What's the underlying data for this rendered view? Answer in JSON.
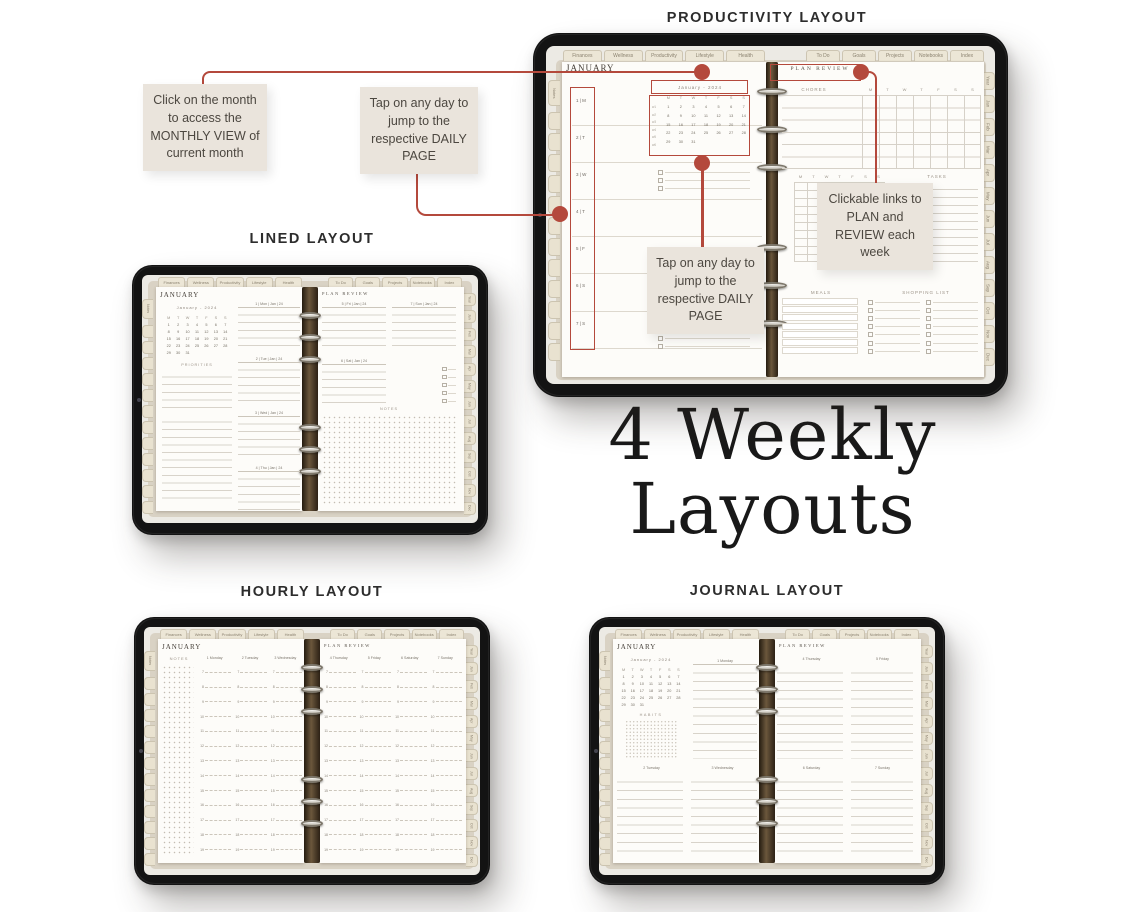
{
  "titles": {
    "productivity": "PRODUCTIVITY LAYOUT",
    "lined": "LINED LAYOUT",
    "hourly": "HOURLY LAYOUT",
    "journal": "JOURNAL LAYOUT"
  },
  "headline": {
    "line1": "4 Weekly",
    "line2": "Layouts"
  },
  "callouts": {
    "monthly_view": "Click on the month to access the MONTHLY VIEW of current month",
    "daily_page_top": "Tap on any day to jump to the respective DAILY PAGE",
    "plan_review_links": "Clickable links to PLAN and REVIEW each week",
    "daily_page_mid": "Tap on any day to jump to the respective DAILY PAGE"
  },
  "colors": {
    "accent_red": "#b4493c",
    "callout_bg": "#eae4dc",
    "callout_text": "#4c4740",
    "tablet_frame": "#131313",
    "planner_cover": "#d9d2c4",
    "tab_beige": "#e9e2d0",
    "page_white": "#fdfcf9",
    "spine_brown": "#6b573c"
  },
  "planner": {
    "tabs_top_left": [
      "Finances",
      "Wellness",
      "Productivity",
      "Lifestyle",
      "Health"
    ],
    "tabs_top_right": [
      "To Do",
      "Goals",
      "Projects",
      "Notebooks",
      "Index"
    ],
    "tabs_right": [
      "Year",
      "Jan",
      "Feb",
      "Mar",
      "Apr",
      "May",
      "Jun",
      "Jul",
      "Aug",
      "Sep",
      "Oct",
      "Nov",
      "Dec"
    ],
    "notes_tab": "Notes",
    "tabs_left_blanks": [
      "",
      "",
      "",
      "",
      "",
      "",
      "",
      "",
      "",
      "",
      "",
      ""
    ],
    "month_title": "JANUARY",
    "plan_review_title": "PLAN REVIEW",
    "mini_calendar": {
      "header": "January - 2024",
      "weekdays": [
        "M",
        "T",
        "W",
        "T",
        "F",
        "S",
        "S"
      ],
      "week_labels": [
        "w1",
        "w2",
        "w3",
        "w4",
        "w5",
        "w6"
      ],
      "days": [
        "1",
        "2",
        "3",
        "4",
        "5",
        "6",
        "7",
        "8",
        "9",
        "10",
        "11",
        "12",
        "13",
        "14",
        "15",
        "16",
        "17",
        "18",
        "19",
        "20",
        "21",
        "22",
        "23",
        "24",
        "25",
        "26",
        "27",
        "28",
        "29",
        "30",
        "31"
      ]
    }
  },
  "productivity": {
    "day_rows": [
      "1 | M",
      "2 | T",
      "3 | W",
      "4 | T",
      "5 | F",
      "6 | S",
      "7 | S"
    ],
    "chores_label": "CHORES",
    "weekday_cols": [
      "M",
      "T",
      "W",
      "T",
      "F",
      "S",
      "S"
    ],
    "tasks_label": "TASKS",
    "meals_label": "MEALS",
    "shopping_label": "SHOPPING LIST"
  },
  "lined": {
    "priorities_label": "PRIORITIES",
    "notes_label": "NOTES",
    "day_headers_left": [
      "1 | Mon | Jan | 24",
      "2 | Tue | Jan | 24",
      "3 | Wed | Jan | 24",
      "4 | Thu | Jan | 24"
    ],
    "day_headers_right_top": [
      "5 | Fri | Jan | 24",
      "7 | Sun | Jan | 24"
    ],
    "day_header_right_mid": "6 | Sat | Jan | 24"
  },
  "hourly": {
    "notes_label": "NOTES",
    "days_left": [
      "1 Monday",
      "2 Tuesday",
      "3 Wednesday"
    ],
    "days_right": [
      "4 Thursday",
      "5 Friday",
      "6 Saturday",
      "7 Sunday"
    ],
    "hours": [
      "7",
      "8",
      "9",
      "10",
      "11",
      "12",
      "13",
      "14",
      "15",
      "16",
      "17",
      "18",
      "19"
    ]
  },
  "journal": {
    "habits_label": "HABITS",
    "day_top_left": "1 Monday",
    "days_bottom_left": [
      "2 Tuesday",
      "3 Wednesday"
    ],
    "days_top_right": [
      "4 Thursday",
      "5 Friday"
    ],
    "days_bottom_right": [
      "6 Saturday",
      "7 Sunday"
    ]
  }
}
